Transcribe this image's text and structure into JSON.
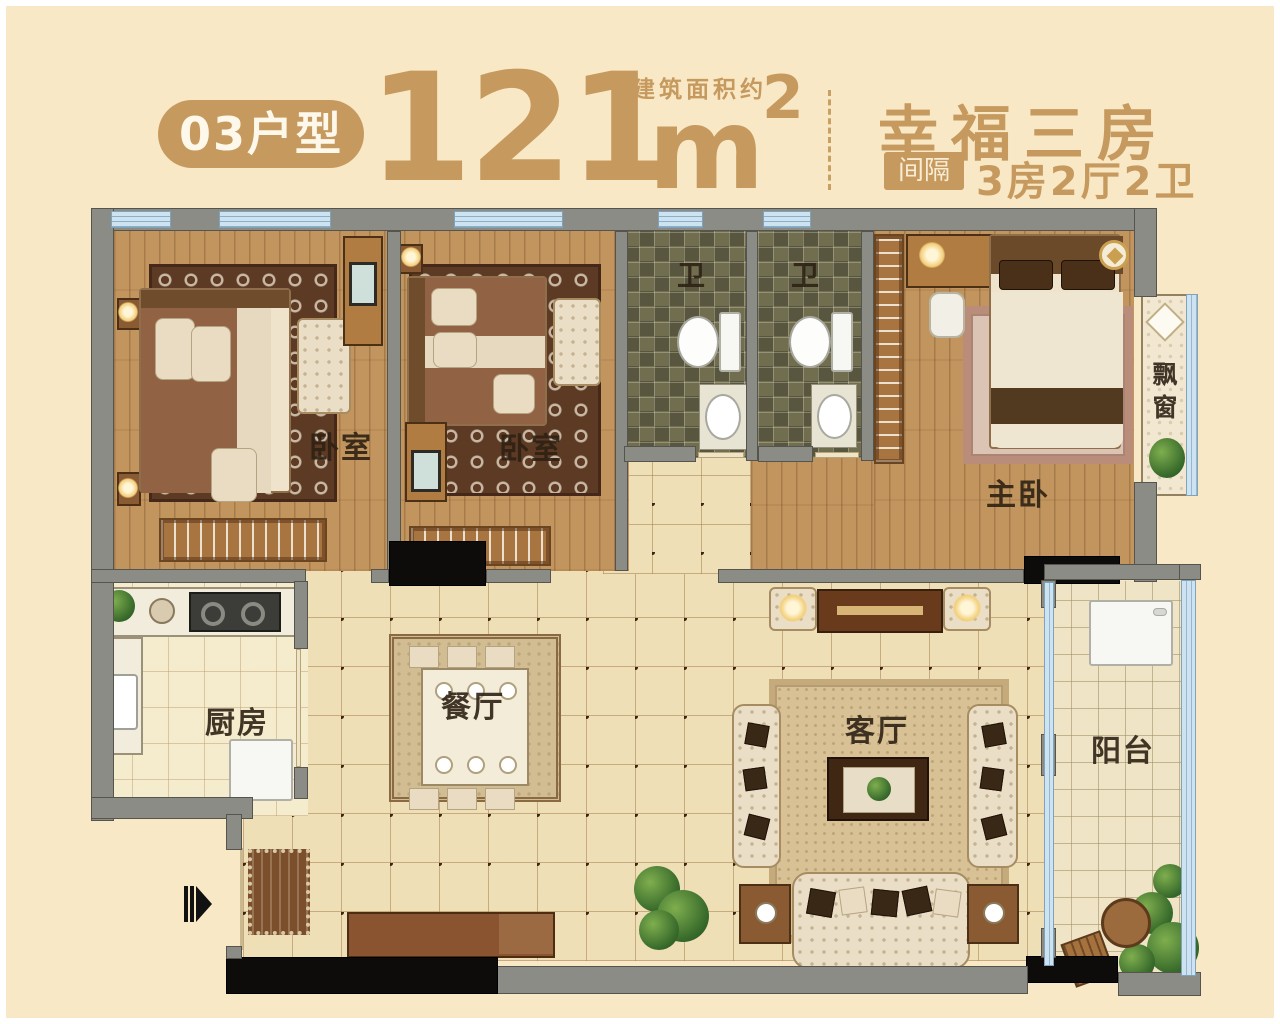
{
  "header": {
    "unit_badge": "03户型",
    "area_number": "121",
    "area_unit": "m",
    "area_exponent": "2",
    "area_note": "建筑面积约",
    "title_right": "幸福三房",
    "divider_badge": "间隔",
    "layout_text": "3房2厅2卫"
  },
  "rooms": {
    "bedroom1": "卧室",
    "bedroom2": "卧室",
    "bathroom1": "卫",
    "bathroom2": "卫",
    "master_bedroom": "主卧",
    "bay_window": "飘窗",
    "kitchen": "厨房",
    "dining_room": "餐厅",
    "living_room": "客厅",
    "balcony": "阳台"
  },
  "colors": {
    "accent_tan": "#c69a5f",
    "background_cream": "#f9e8c5",
    "wall_gray": "#8b8c86",
    "wall_black": "#0d0c0a",
    "window_blue": "#cde3f1",
    "label_dark": "#33281b"
  }
}
